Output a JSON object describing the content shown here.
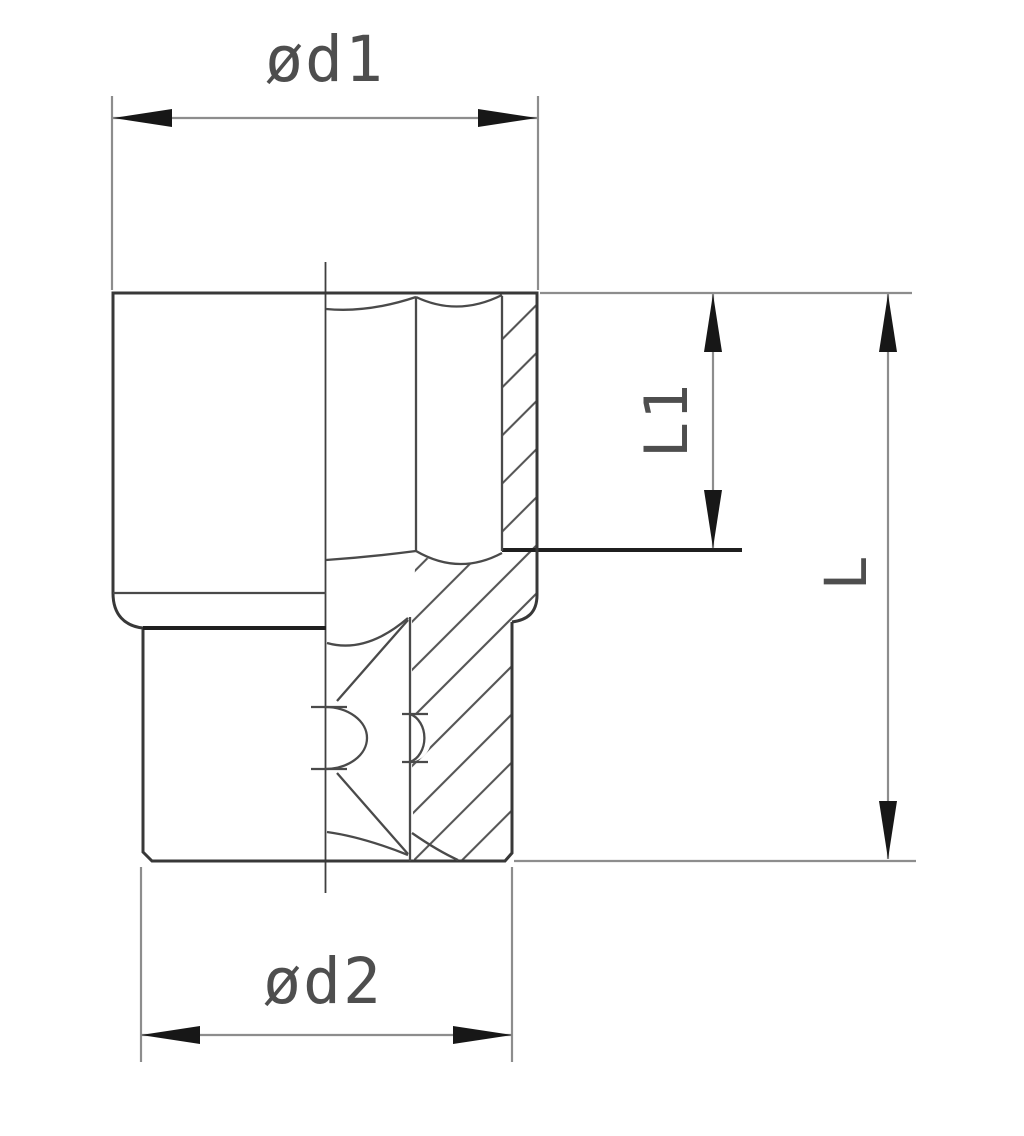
{
  "drawing": {
    "kind": "engineering half-section drawing",
    "subject": "socket (hex opening top, square drive bottom)",
    "background_color": "#ffffff",
    "outline_color": "#383838",
    "dimension_line_color": "#8d8d8d",
    "arrow_color": "#171717",
    "label_color": "#4e4e4e",
    "dimensions": [
      {
        "id": "d1",
        "label": "ød1",
        "orientation": "horizontal",
        "position": "top"
      },
      {
        "id": "d2",
        "label": "ød2",
        "orientation": "horizontal",
        "position": "bottom"
      },
      {
        "id": "L1",
        "label": "L1",
        "orientation": "vertical",
        "position": "inner-right"
      },
      {
        "id": "L",
        "label": "L",
        "orientation": "vertical",
        "position": "outer-right"
      }
    ]
  },
  "labels": {
    "d1": "ød1",
    "d2": "ød2",
    "l1": "L1",
    "l": "L"
  }
}
